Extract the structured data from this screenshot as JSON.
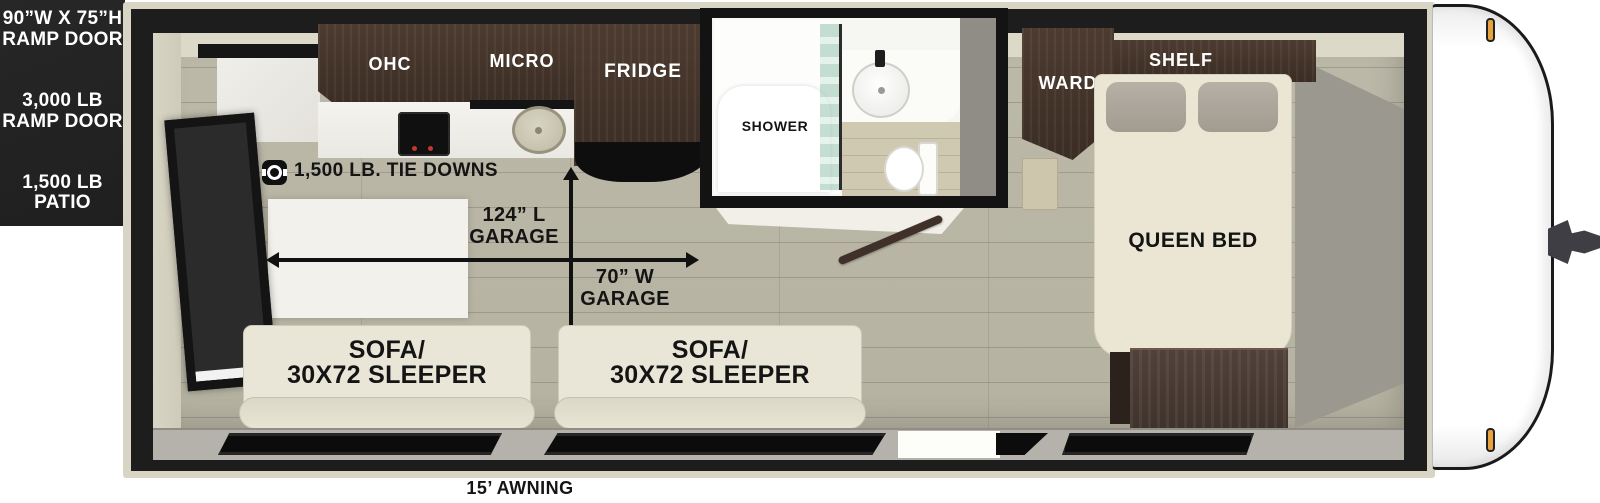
{
  "title": "Travel trailer floor plan",
  "colors": {
    "wall_black": "#1d1d1d",
    "frame_beige": "#d9d5c5",
    "floor_wood": "#b9b6a6",
    "cabinet_wood": "#45362c",
    "cushion_cream": "#e9e6d7",
    "spec_panel_dark": "#242424",
    "marker_light_amber": "#e7a43e"
  },
  "icons": {
    "tie_down": "d-ring-anchor-icon"
  },
  "exterior": {
    "ramp_door_size_line1": "90”W X 75”H",
    "ramp_door_size_line2": "RAMP DOOR",
    "ramp_door_weight_line1": "3,000 LB",
    "ramp_door_weight_line2": "RAMP DOOR",
    "patio_line1": "1,500 LB",
    "patio_line2": "PATIO",
    "awning": "15’ AWNING"
  },
  "kitchen": {
    "ohc": "OHC",
    "micro": "MICRO",
    "fridge": "FRIDGE"
  },
  "garage": {
    "tie_downs": "1,500 LB. TIE DOWNS",
    "length_line1": "124” L",
    "length_line2": "GARAGE",
    "width_line1": "70” W",
    "width_line2": "GARAGE"
  },
  "bathroom": {
    "shower": "SHOWER"
  },
  "bedroom": {
    "ward": "WARD",
    "shelf": "SHELF",
    "queen_bed": "QUEEN BED"
  },
  "seating": {
    "sofa1_line1": "SOFA/",
    "sofa1_line2": "30X72 SLEEPER",
    "sofa2_line1": "SOFA/",
    "sofa2_line2": "30X72 SLEEPER"
  }
}
